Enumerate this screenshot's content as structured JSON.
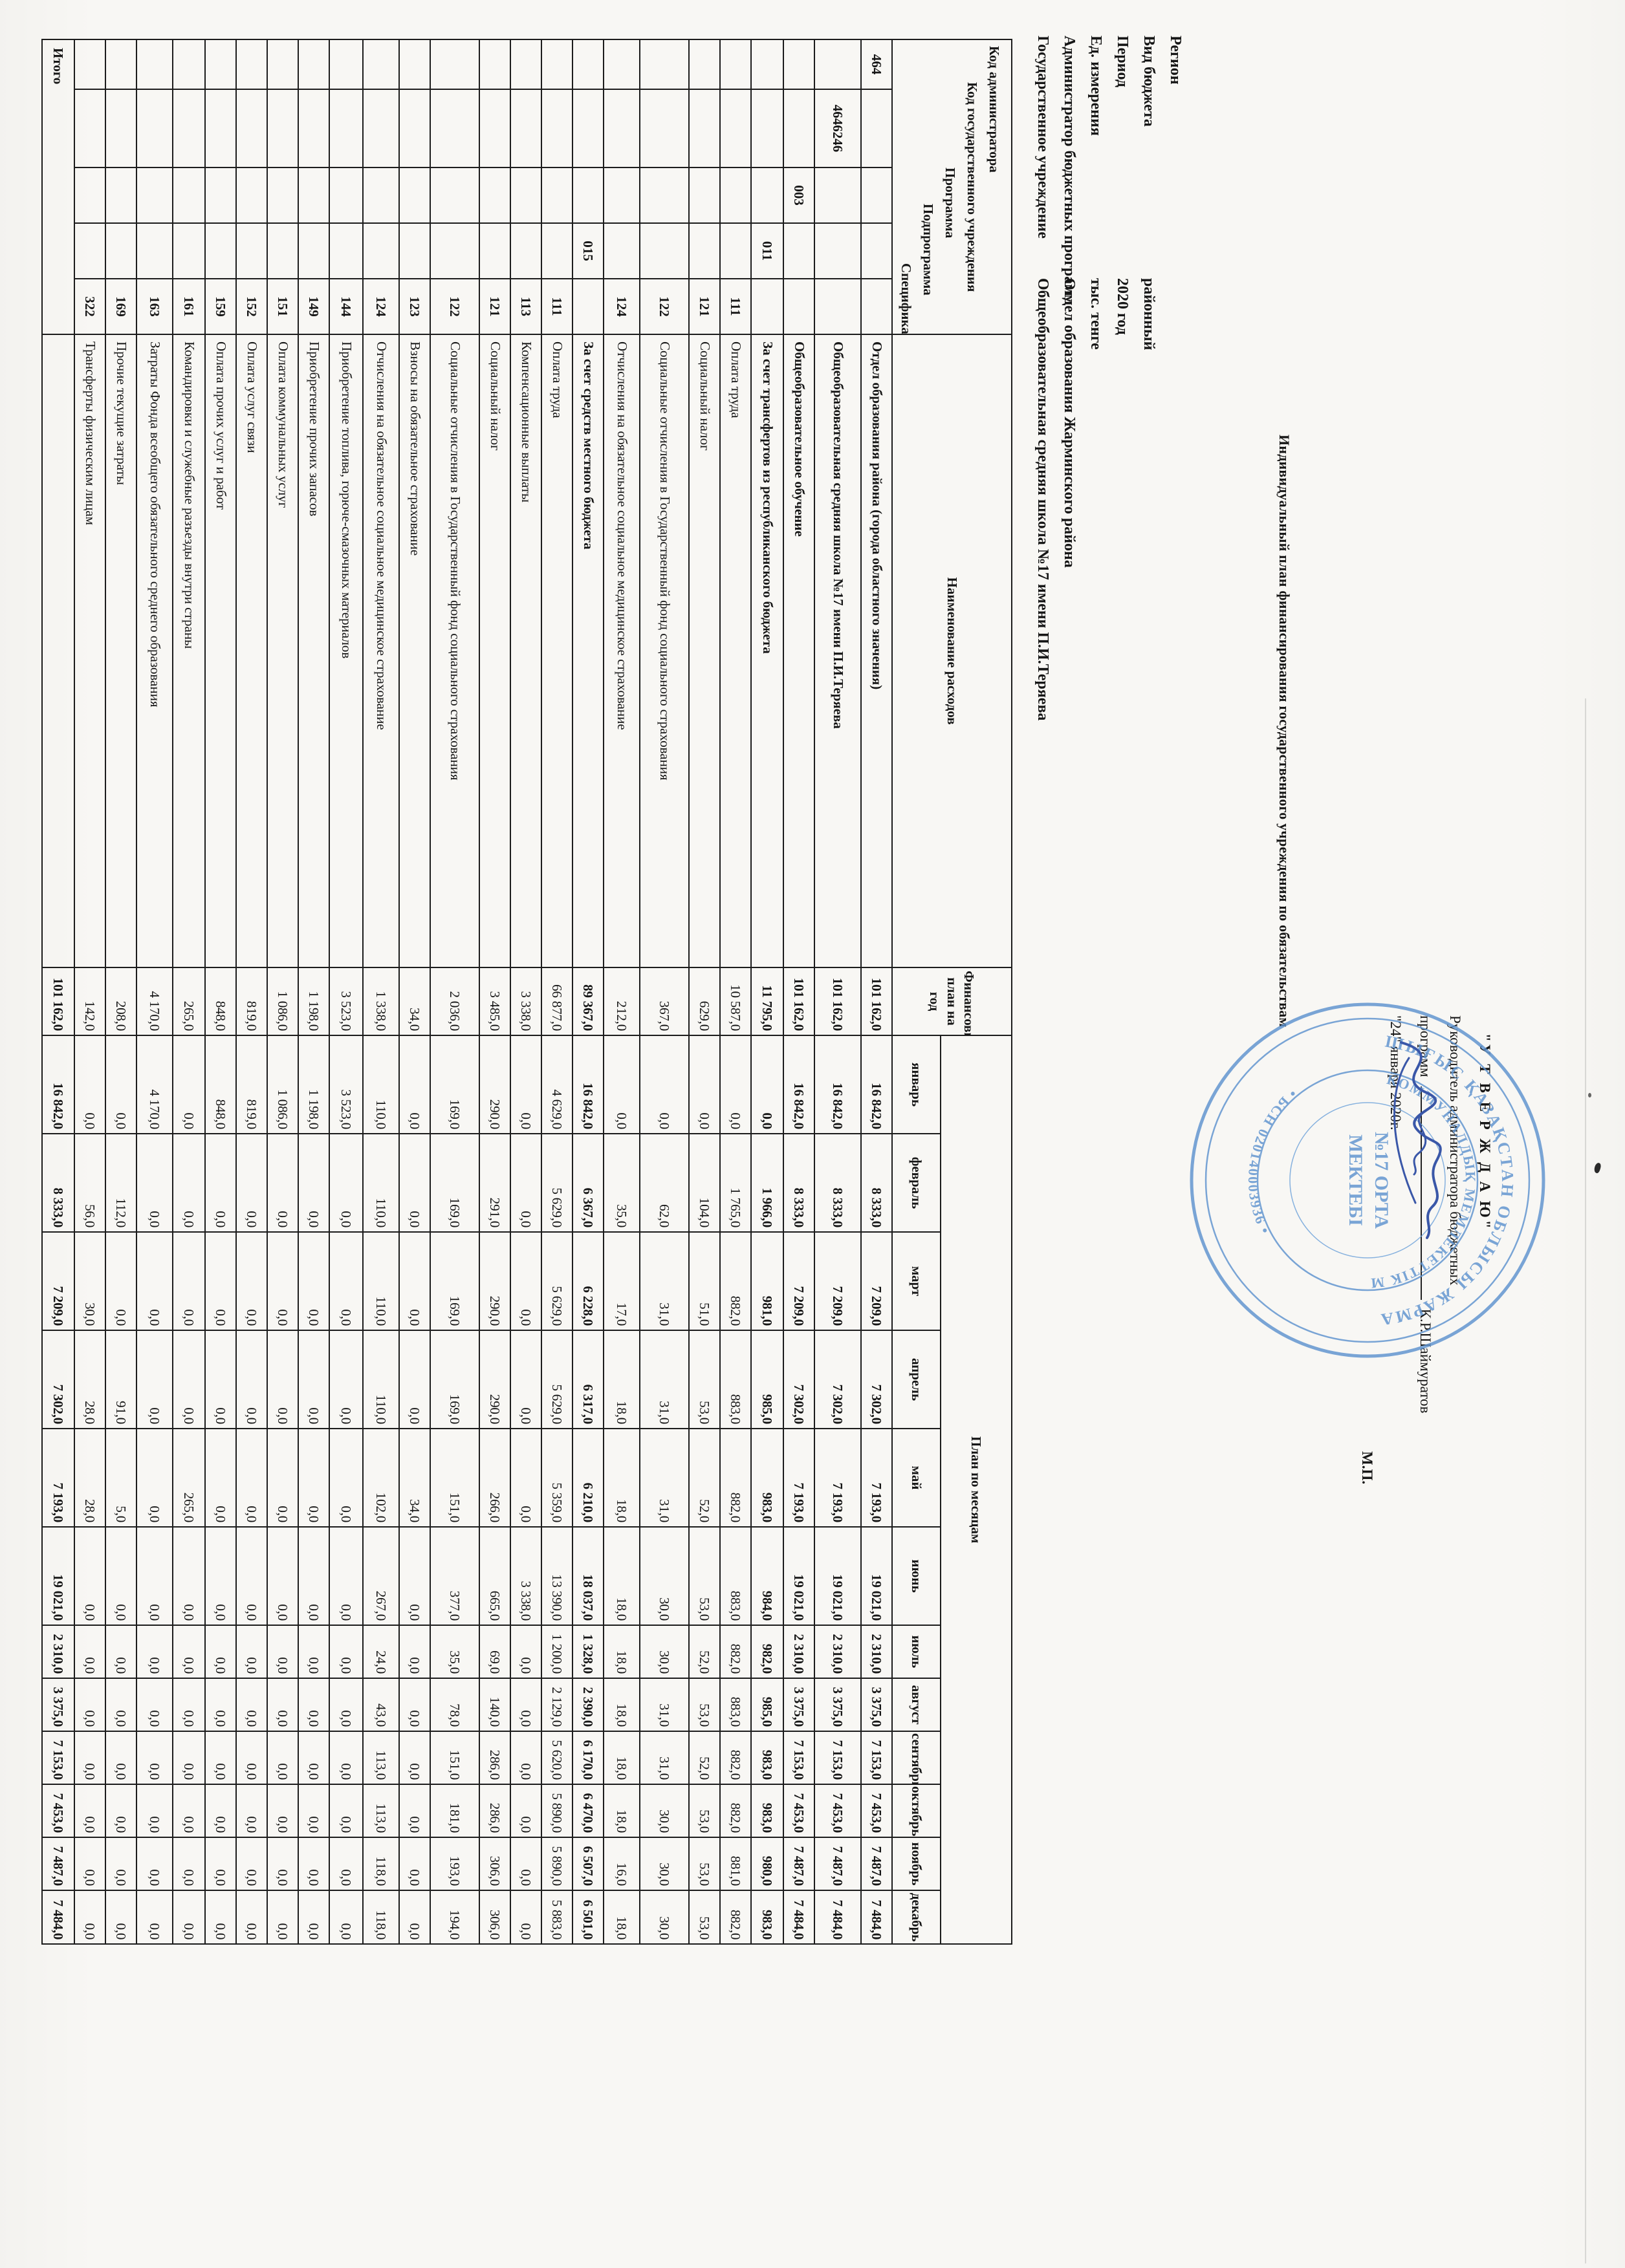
{
  "meta": {
    "rows": [
      {
        "label": "Регион",
        "value": ""
      },
      {
        "label": "Вид бюджета",
        "value": "районный"
      },
      {
        "label": "Период",
        "value": "2020 год"
      },
      {
        "label": "Ед. измерения",
        "value": "тыс. тенге"
      },
      {
        "label": "Администратор бюджетных программ",
        "value": "Отдел образования Жарминского района"
      },
      {
        "label": "Государственное учреждение",
        "value": "Общеобразовательная средняя школа №17 имени П.И.Теряева"
      }
    ]
  },
  "title": "Индивидуальный план финансирования государственного учреждения по обязательствам",
  "approval": {
    "approve_word": "\"У Т В Е Р Ж Д А Ю\"",
    "line1": "Руководитель администратора бюджетных",
    "line2_prefix": "программ",
    "signer": "К.Р.Шаймуратов",
    "date": "\"24\" января 2020г.",
    "mp": "М.П."
  },
  "stamp": {
    "outer_text": "ШЫҒЫС ҚАЗАҚСТАН ОБЛЫСЫ ЖАРМА АУДАНЫ ӘКІМДІГІНІҢ",
    "mid_text": "КОММУНАЛДЫҚ МЕМЛЕКЕТТІК МЕКЕМЕСІ",
    "bsn_text": "• БСН 020140003936 •",
    "center_line1": "№17 ОРТА",
    "center_line2": "МЕКТЕБІ"
  },
  "table": {
    "header": {
      "code_labels": [
        "Код администратора",
        "Код государственного учреждения",
        "Программа",
        "Подпрограмма",
        "Специфика"
      ],
      "name_label": "Наименование расходов",
      "plan_year_label": "Финансовый план на год",
      "months_label": "План по месяцам",
      "months": [
        "январь",
        "февраль",
        "март",
        "апрель",
        "май",
        "июнь",
        "июль",
        "август",
        "сентябрь",
        "октябрь",
        "ноябрь",
        "декабрь"
      ]
    },
    "rows": [
      {
        "codes": [
          "464",
          "",
          "",
          "",
          ""
        ],
        "bold": true,
        "name": "Отдел образования района (города областного значения)",
        "values": [
          "101 162,0",
          "16 842,0",
          "8 333,0",
          "7 209,0",
          "7 302,0",
          "7 193,0",
          "19 021,0",
          "2 310,0",
          "3 375,0",
          "7 153,0",
          "7 453,0",
          "7 487,0",
          "7 484,0"
        ]
      },
      {
        "codes": [
          "",
          "4646246",
          "",
          "",
          ""
        ],
        "bold": true,
        "name": "Общеобразовательная средняя школа №17 имени П.И.Теряева",
        "values": [
          "101 162,0",
          "16 842,0",
          "8 333,0",
          "7 209,0",
          "7 302,0",
          "7 193,0",
          "19 021,0",
          "2 310,0",
          "3 375,0",
          "7 153,0",
          "7 453,0",
          "7 487,0",
          "7 484,0"
        ]
      },
      {
        "codes": [
          "",
          "",
          "003",
          "",
          ""
        ],
        "bold": true,
        "name": "Общеобразовательное обучение",
        "values": [
          "101 162,0",
          "16 842,0",
          "8 333,0",
          "7 209,0",
          "7 302,0",
          "7 193,0",
          "19 021,0",
          "2 310,0",
          "3 375,0",
          "7 153,0",
          "7 453,0",
          "7 487,0",
          "7 484,0"
        ]
      },
      {
        "codes": [
          "",
          "",
          "",
          "011",
          ""
        ],
        "bold": true,
        "name": "За счет трансфертов из республиканского бюджета",
        "values": [
          "11 795,0",
          "0,0",
          "1 966,0",
          "981,0",
          "985,0",
          "983,0",
          "984,0",
          "982,0",
          "985,0",
          "983,0",
          "983,0",
          "980,0",
          "983,0"
        ]
      },
      {
        "codes": [
          "",
          "",
          "",
          "",
          "111"
        ],
        "bold": false,
        "name": "Оплата труда",
        "values": [
          "10 587,0",
          "0,0",
          "1 765,0",
          "882,0",
          "883,0",
          "882,0",
          "883,0",
          "882,0",
          "883,0",
          "882,0",
          "882,0",
          "881,0",
          "882,0"
        ]
      },
      {
        "codes": [
          "",
          "",
          "",
          "",
          "121"
        ],
        "bold": false,
        "name": "Социальный налог",
        "values": [
          "629,0",
          "0,0",
          "104,0",
          "51,0",
          "53,0",
          "52,0",
          "53,0",
          "52,0",
          "53,0",
          "52,0",
          "53,0",
          "53,0",
          "53,0"
        ]
      },
      {
        "codes": [
          "",
          "",
          "",
          "",
          "122"
        ],
        "bold": false,
        "name": "Социальные отчисления в Государственный фонд социального страхования",
        "values": [
          "367,0",
          "0,0",
          "62,0",
          "31,0",
          "31,0",
          "31,0",
          "30,0",
          "30,0",
          "31,0",
          "31,0",
          "30,0",
          "30,0",
          "30,0"
        ]
      },
      {
        "codes": [
          "",
          "",
          "",
          "",
          "124"
        ],
        "bold": false,
        "name": "Отчисления на обязательное социальное медицинское страхование",
        "values": [
          "212,0",
          "0,0",
          "35,0",
          "17,0",
          "18,0",
          "18,0",
          "18,0",
          "18,0",
          "18,0",
          "18,0",
          "18,0",
          "16,0",
          "18,0"
        ]
      },
      {
        "codes": [
          "",
          "",
          "",
          "015",
          ""
        ],
        "bold": true,
        "name": "За счет средств местного бюджета",
        "values": [
          "89 367,0",
          "16 842,0",
          "6 367,0",
          "6 228,0",
          "6 317,0",
          "6 210,0",
          "18 037,0",
          "1 328,0",
          "2 390,0",
          "6 170,0",
          "6 470,0",
          "6 507,0",
          "6 501,0"
        ]
      },
      {
        "codes": [
          "",
          "",
          "",
          "",
          "111"
        ],
        "bold": false,
        "name": "Оплата труда",
        "values": [
          "66 877,0",
          "4 629,0",
          "5 629,0",
          "5 629,0",
          "5 629,0",
          "5 359,0",
          "13 390,0",
          "1 200,0",
          "2 129,0",
          "5 620,0",
          "5 890,0",
          "5 890,0",
          "5 883,0"
        ]
      },
      {
        "codes": [
          "",
          "",
          "",
          "",
          "113"
        ],
        "bold": false,
        "name": "Компенсационные выплаты",
        "values": [
          "3 338,0",
          "0,0",
          "0,0",
          "0,0",
          "0,0",
          "0,0",
          "3 338,0",
          "0,0",
          "0,0",
          "0,0",
          "0,0",
          "0,0",
          "0,0"
        ]
      },
      {
        "codes": [
          "",
          "",
          "",
          "",
          "121"
        ],
        "bold": false,
        "name": "Социальный налог",
        "values": [
          "3 485,0",
          "290,0",
          "291,0",
          "290,0",
          "290,0",
          "266,0",
          "665,0",
          "69,0",
          "140,0",
          "286,0",
          "286,0",
          "306,0",
          "306,0"
        ]
      },
      {
        "codes": [
          "",
          "",
          "",
          "",
          "122"
        ],
        "bold": false,
        "name": "Социальные отчисления в Государственный фонд социального страхования",
        "values": [
          "2 036,0",
          "169,0",
          "169,0",
          "169,0",
          "169,0",
          "151,0",
          "377,0",
          "35,0",
          "78,0",
          "151,0",
          "181,0",
          "193,0",
          "194,0"
        ]
      },
      {
        "codes": [
          "",
          "",
          "",
          "",
          "123"
        ],
        "bold": false,
        "name": "Взносы на обязательное страхование",
        "values": [
          "34,0",
          "0,0",
          "0,0",
          "0,0",
          "0,0",
          "34,0",
          "0,0",
          "0,0",
          "0,0",
          "0,0",
          "0,0",
          "0,0",
          "0,0"
        ]
      },
      {
        "codes": [
          "",
          "",
          "",
          "",
          "124"
        ],
        "bold": false,
        "name": "Отчисления на обязательное социальное медицинское страхование",
        "values": [
          "1 338,0",
          "110,0",
          "110,0",
          "110,0",
          "110,0",
          "102,0",
          "267,0",
          "24,0",
          "43,0",
          "113,0",
          "113,0",
          "118,0",
          "118,0"
        ]
      },
      {
        "codes": [
          "",
          "",
          "",
          "",
          "144"
        ],
        "bold": false,
        "name": "Приобретение топлива, горюче-смазочных материалов",
        "values": [
          "3 523,0",
          "3 523,0",
          "0,0",
          "0,0",
          "0,0",
          "0,0",
          "0,0",
          "0,0",
          "0,0",
          "0,0",
          "0,0",
          "0,0",
          "0,0"
        ]
      },
      {
        "codes": [
          "",
          "",
          "",
          "",
          "149"
        ],
        "bold": false,
        "name": "Приобретение прочих запасов",
        "values": [
          "1 198,0",
          "1 198,0",
          "0,0",
          "0,0",
          "0,0",
          "0,0",
          "0,0",
          "0,0",
          "0,0",
          "0,0",
          "0,0",
          "0,0",
          "0,0"
        ]
      },
      {
        "codes": [
          "",
          "",
          "",
          "",
          "151"
        ],
        "bold": false,
        "name": "Оплата коммунальных услуг",
        "values": [
          "1 086,0",
          "1 086,0",
          "0,0",
          "0,0",
          "0,0",
          "0,0",
          "0,0",
          "0,0",
          "0,0",
          "0,0",
          "0,0",
          "0,0",
          "0,0"
        ]
      },
      {
        "codes": [
          "",
          "",
          "",
          "",
          "152"
        ],
        "bold": false,
        "name": "Оплата услуг связи",
        "values": [
          "819,0",
          "819,0",
          "0,0",
          "0,0",
          "0,0",
          "0,0",
          "0,0",
          "0,0",
          "0,0",
          "0,0",
          "0,0",
          "0,0",
          "0,0"
        ]
      },
      {
        "codes": [
          "",
          "",
          "",
          "",
          "159"
        ],
        "bold": false,
        "name": "Оплата прочих услуг и работ",
        "values": [
          "848,0",
          "848,0",
          "0,0",
          "0,0",
          "0,0",
          "0,0",
          "0,0",
          "0,0",
          "0,0",
          "0,0",
          "0,0",
          "0,0",
          "0,0"
        ]
      },
      {
        "codes": [
          "",
          "",
          "",
          "",
          "161"
        ],
        "bold": false,
        "name": "Командировки и служебные разъезды внутри страны",
        "values": [
          "265,0",
          "0,0",
          "0,0",
          "0,0",
          "0,0",
          "265,0",
          "0,0",
          "0,0",
          "0,0",
          "0,0",
          "0,0",
          "0,0",
          "0,0"
        ]
      },
      {
        "codes": [
          "",
          "",
          "",
          "",
          "163"
        ],
        "bold": false,
        "name": "Затраты Фонда всеобщего обязательного среднего образования",
        "values": [
          "4 170,0",
          "4 170,0",
          "0,0",
          "0,0",
          "0,0",
          "0,0",
          "0,0",
          "0,0",
          "0,0",
          "0,0",
          "0,0",
          "0,0",
          "0,0"
        ]
      },
      {
        "codes": [
          "",
          "",
          "",
          "",
          "169"
        ],
        "bold": false,
        "name": "Прочие текущие затраты",
        "values": [
          "208,0",
          "0,0",
          "112,0",
          "0,0",
          "91,0",
          "5,0",
          "0,0",
          "0,0",
          "0,0",
          "0,0",
          "0,0",
          "0,0",
          "0,0"
        ]
      },
      {
        "codes": [
          "",
          "",
          "",
          "",
          "322"
        ],
        "bold": false,
        "name": "Трансферты физическим лицам",
        "values": [
          "142,0",
          "0,0",
          "56,0",
          "30,0",
          "28,0",
          "28,0",
          "0,0",
          "0,0",
          "0,0",
          "0,0",
          "0,0",
          "0,0",
          "0,0"
        ]
      },
      {
        "total": true,
        "bold": true,
        "name": "Итого",
        "values": [
          "101 162,0",
          "16 842,0",
          "8 333,0",
          "7 209,0",
          "7 302,0",
          "7 193,0",
          "19 021,0",
          "2 310,0",
          "3 375,0",
          "7 153,0",
          "7 453,0",
          "7 487,0",
          "7 484,0"
        ]
      }
    ]
  }
}
